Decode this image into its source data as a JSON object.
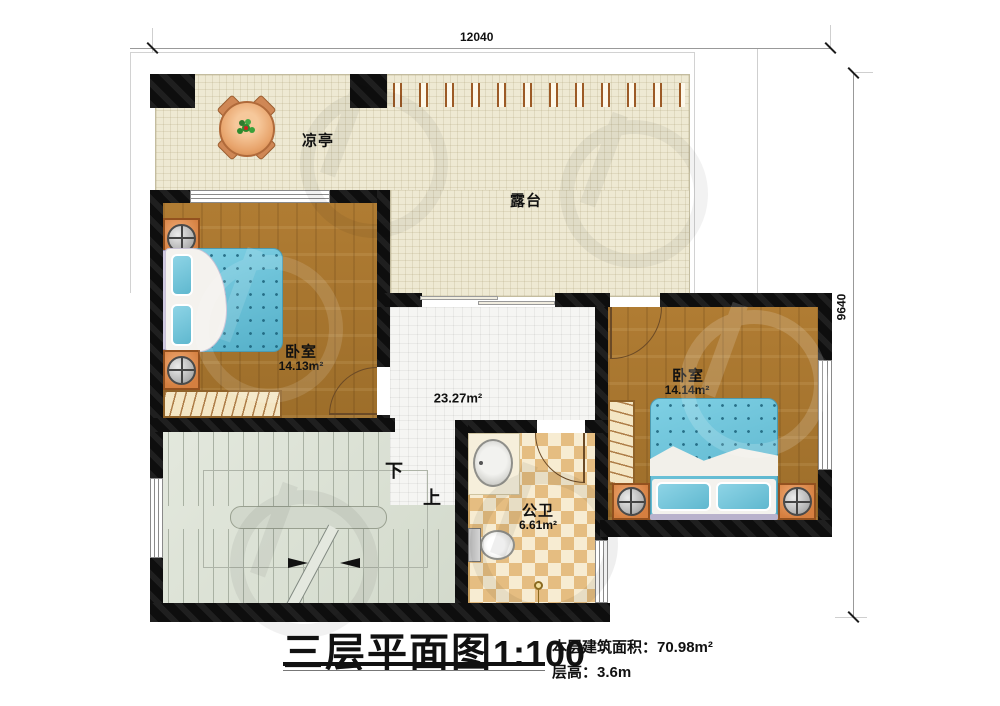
{
  "dimensions": {
    "top": "12040",
    "right": "9640"
  },
  "rooms": {
    "terrace": {
      "label": "露台"
    },
    "pavilion": {
      "label": "凉亭"
    },
    "bedroom_left": {
      "label": "卧室",
      "area": "14.13m²"
    },
    "bedroom_right": {
      "label": "卧室",
      "area": "14.14m²"
    },
    "bathroom": {
      "label": "公卫",
      "area": "6.61m²"
    },
    "hall": {
      "area": "23.27m²"
    },
    "stairs": {
      "down": "下",
      "up": "上"
    }
  },
  "title_block": {
    "title": "三层平面图",
    "scale": "1:100",
    "area_text": "本层建筑面积：70.98m²",
    "floor_height_text": "层高：3.6m"
  },
  "colors": {
    "wall": "#0e0e0e",
    "wood": "#a8752f",
    "terrace": "#eee9d3",
    "tile": "#f5f5f3",
    "bath_tan": "#e5bd81",
    "stairs": "#dce1d6",
    "bed": "#62bfd8",
    "orange": "#dd8a4e"
  }
}
